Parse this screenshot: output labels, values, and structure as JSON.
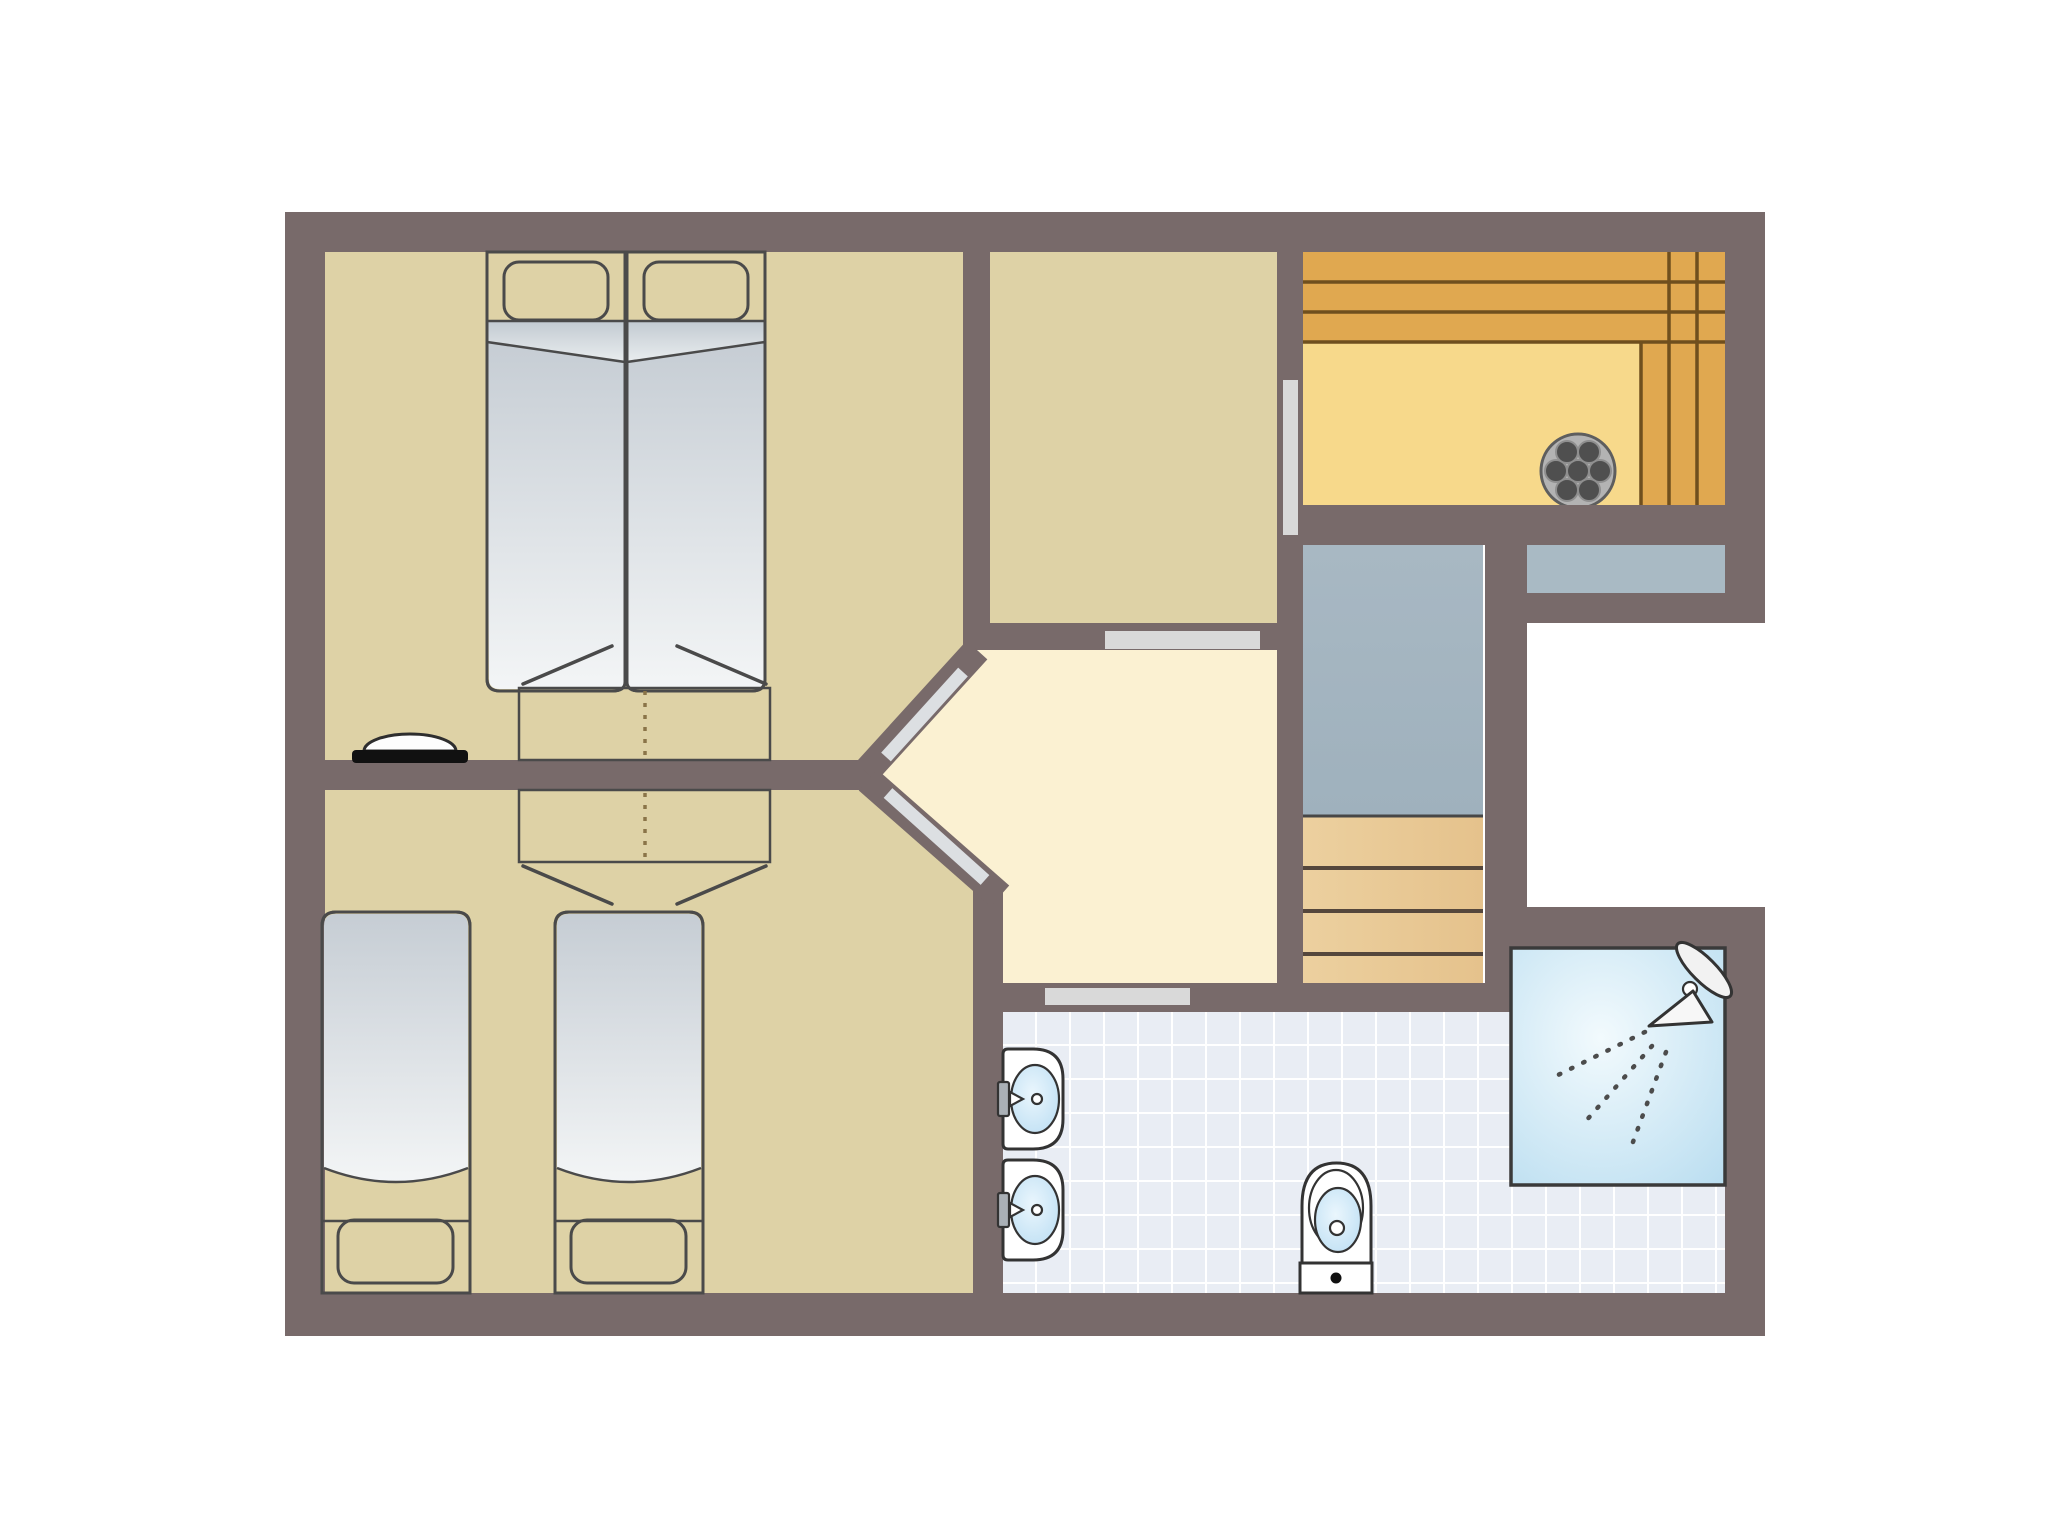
{
  "canvas": {
    "width": 2048,
    "height": 1536,
    "background": "#ffffff"
  },
  "colors": {
    "wall": "#786a6a",
    "bedroom_floor": "#ded2a6",
    "hallway_floor": "#fbf1d2",
    "door_marker": "#d9d9d9",
    "door_leaf": "#dcdfe2",
    "outline_dark": "#4a4a4a",
    "fixture_outline": "#333333",
    "fixture_white": "#ffffff",
    "wardrobe_wood": "#eed6a1",
    "wardrobe_dash": "#8a7448",
    "sauna_bench": "#e0a850",
    "sauna_seam": "#6f4f1e",
    "sauna_floor": "#f7d98b",
    "stove_base": "#b3b3b3",
    "stove_stone": "#4f4f4f",
    "stairs_landing": "#9fb1bd",
    "stair_step": "#e5c28c",
    "stair_seam": "#55473c",
    "railing": "#a9bac4",
    "tile_floor": "#e9edf4",
    "tile_grid": "#ffffff",
    "shower_center": "#f2fafd",
    "shower_edge": "#b9ddf0",
    "water_center": "#eaf6fd",
    "water_edge": "#b8dcf2",
    "blanket_top": "#c6cdd4",
    "blanket_bottom": "#f3f5f6",
    "pillow_top": "#dfe3e7",
    "pillow_bottom": "#f7f9fa",
    "basin_tap": "#aab0b6",
    "black": "#111111"
  },
  "rooms": [
    {
      "id": "bedroom-top-left",
      "contents": "double bed (two joined mattresses), two wardrobes, washbasin"
    },
    {
      "id": "bedroom-bottom-left",
      "contents": "two single beds, two wardrobes"
    },
    {
      "id": "room-top-middle",
      "contents": "empty room"
    },
    {
      "id": "sauna",
      "contents": "L-shaped bench planks, stone stove"
    },
    {
      "id": "hallway",
      "contents": "landing with three doors"
    },
    {
      "id": "staircase",
      "contents": "landing and four wooden steps, railing ledge"
    },
    {
      "id": "void",
      "contents": "open recess"
    },
    {
      "id": "bathroom",
      "contents": "tiled floor, two washbasins, toilet, shower with shower head"
    }
  ],
  "furniture_counts": {
    "double_beds": 1,
    "single_beds": 2,
    "pillows": 4,
    "wardrobes": 2,
    "bedroom_washbasins": 1,
    "bathroom_sinks": 2,
    "toilets": 1,
    "showers": 1,
    "sauna_stoves": 1,
    "stair_steps": 4,
    "door_openings": 5
  }
}
